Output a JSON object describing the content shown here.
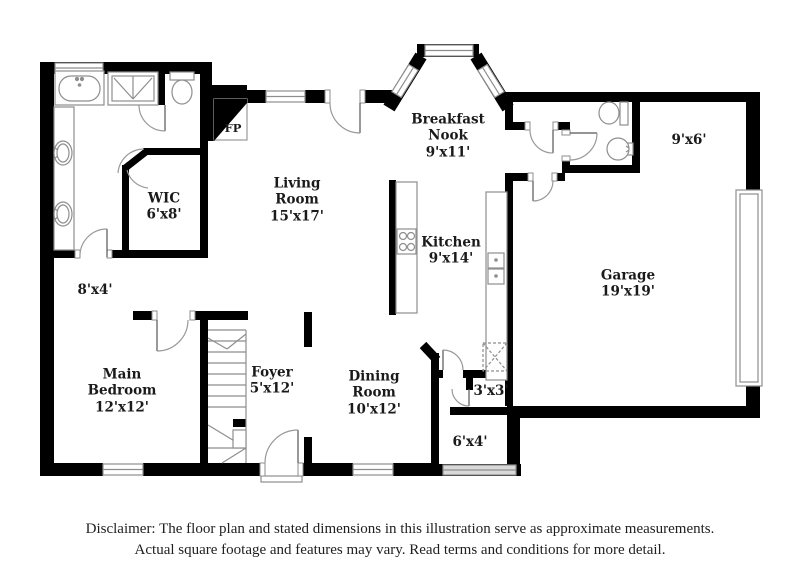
{
  "colors": {
    "wall": "#000000",
    "fixture_stroke": "#8e8e8e",
    "label_text": "#1a1a1a",
    "window_fill": "#ffffff",
    "entry_window_fill": "#d9d9d9"
  },
  "rooms": [
    {
      "id": "living-room",
      "name": "Living\nRoom",
      "dims": "15'x17'"
    },
    {
      "id": "breakfast-nook",
      "name": "Breakfast\nNook",
      "dims": "9'x11'"
    },
    {
      "id": "kitchen",
      "name": "Kitchen",
      "dims": "9'x14'"
    },
    {
      "id": "garage",
      "name": "Garage",
      "dims": "19'x19'"
    },
    {
      "id": "main-bedroom",
      "name": "Main\nBedroom",
      "dims": "12'x12'"
    },
    {
      "id": "foyer",
      "name": "Foyer",
      "dims": "5'x12'"
    },
    {
      "id": "dining-room",
      "name": "Dining\nRoom",
      "dims": "10'x12'"
    },
    {
      "id": "wic",
      "name": "WIC",
      "dims": "6'x8'"
    },
    {
      "id": "hall",
      "name": "",
      "dims": "8'x4'"
    },
    {
      "id": "storage",
      "name": "",
      "dims": "9'x6'"
    },
    {
      "id": "closet",
      "name": "",
      "dims": "3'x3'"
    },
    {
      "id": "entry",
      "name": "",
      "dims": "6'x4'"
    },
    {
      "id": "fireplace",
      "name": "FP",
      "dims": ""
    }
  ],
  "fixtures": [
    "bathtub",
    "shower",
    "toilet",
    "double-vanity",
    "half-bath-toilet",
    "pedestal-sink",
    "kitchen-island-cooktop",
    "kitchen-sink",
    "pantry",
    "stairs",
    "bay-window",
    "garage-door",
    "fireplace",
    "front-door"
  ],
  "disclaimer": {
    "line1": "Disclaimer: The floor plan and stated dimensions in this illustration serve as approximate measurements.",
    "line2": "Actual square footage and features may vary. Read terms and conditions for more detail."
  }
}
